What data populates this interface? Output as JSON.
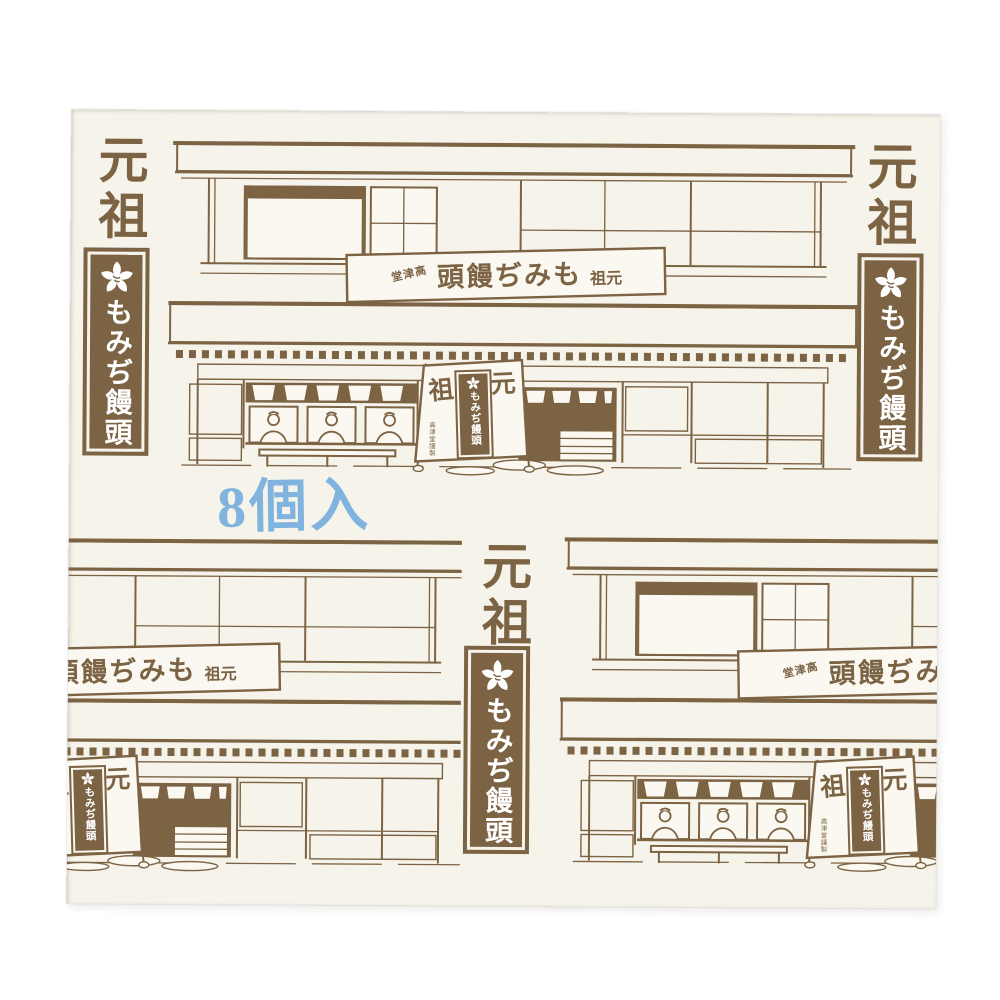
{
  "colors": {
    "ink_brown": "#7c6344",
    "package_cream": "#f6f3ea",
    "photo_white": "#ffffff",
    "stamp_blue": "#74aedd"
  },
  "stamps": {
    "top_left": "元祖",
    "top_right": "元祖",
    "bottom_center": "元祖"
  },
  "logo_banner": {
    "icon": "maple-blossom",
    "text": "もみぢ饅頭"
  },
  "count_stamp": {
    "text": "8個入"
  },
  "building": {
    "sign": {
      "shop_name_rtl": "堂津高",
      "title_rtl": "頭饅ぢみも",
      "suffix_rtl": "祖元"
    },
    "stand_banner": {
      "left_char": "祖",
      "right_char": "元",
      "inner_text": "もみぢ饅頭",
      "fine_print": "高津堂謹製"
    }
  }
}
